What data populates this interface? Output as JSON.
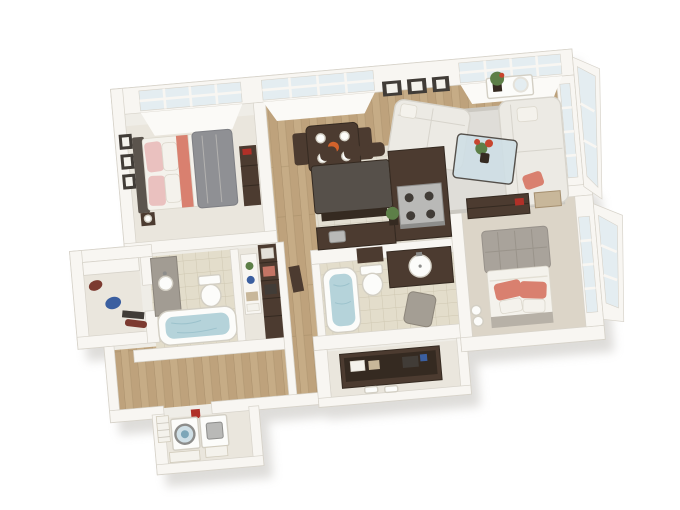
{
  "scene": {
    "type": "3d-isometric-floor-plan",
    "description": "Top-down 3D rendering of a two bedroom, two bathroom apartment floor plan on a white background, rotated slightly counterclockwise",
    "rooms": [
      {
        "name": "bedroom-1",
        "furniture": [
          "bed-gray-duvet",
          "pink-pillows",
          "coral-throw",
          "headboard",
          "dresser",
          "nightstand-lamp",
          "wall-frames-x3",
          "picture-window"
        ]
      },
      {
        "name": "dining-area",
        "furniture": [
          "dark-wood-table",
          "two-chairs",
          "place-settings",
          "orange-bowl",
          "window"
        ]
      },
      {
        "name": "living-room",
        "furniture": [
          "white-sofa",
          "white-chaise-sofa",
          "coral-accent-pillow",
          "glass-coffee-table",
          "flower-centerpiece",
          "area-rug",
          "console-table",
          "potted-plant",
          "round-mirror",
          "wall-frames-x3",
          "corner-window-wall"
        ]
      },
      {
        "name": "kitchen",
        "furniture": [
          "granite-island",
          "three-bar-stools",
          "l-shaped-espresso-counter",
          "stainless-range",
          "sink",
          "potted-plant"
        ]
      },
      {
        "name": "bedroom-2",
        "furniture": [
          "bed-white-duvet",
          "tufted-headboard",
          "coral-pillows",
          "media-console",
          "wood-chest",
          "window-wall"
        ]
      },
      {
        "name": "bathroom-1",
        "furniture": [
          "bathtub",
          "gray-vanity-sink",
          "toilet",
          "linen-shelf"
        ]
      },
      {
        "name": "bathroom-2",
        "furniture": [
          "bathtub",
          "toilet",
          "espresso-vanity-round-sink",
          "wall-cabinet",
          "hamper"
        ]
      },
      {
        "name": "walk-in-closet",
        "furniture": [
          "espresso-wardrobe",
          "storage-shelf",
          "hall-console"
        ]
      },
      {
        "name": "closet-2",
        "furniture": [
          "espresso-shelving-unit",
          "storage-boxes",
          "step-stools"
        ]
      },
      {
        "name": "storage-closet",
        "furniture": [
          "shelf",
          "maroon-bag",
          "blue-bag",
          "accessories"
        ]
      },
      {
        "name": "laundry-room",
        "furniture": [
          "front-load-washer",
          "dryer",
          "red-detergent",
          "laundry-baskets"
        ]
      }
    ],
    "palette": {
      "bg": "#ffffff",
      "wallBase": "#efede7",
      "wall": "#f8f6f2",
      "wallLight": "#fbfaf7",
      "wallEdge": "#d7d3ca",
      "shadow": "#a9a59e",
      "wood": "#c6ac86",
      "woodDark": "#b3976f",
      "woodLine": "#9e8460",
      "tile": "#e4dfd2",
      "tileLine": "#d1cbbb",
      "bathTile": "#e3ddcb",
      "bathTileLine": "#cfc8b2",
      "paleFloor": "#eae6dd",
      "warmFloor": "#dcd5c8",
      "glass": "#e4edf1",
      "glassDark": "#cfdfe6",
      "frameDark": "#413c37",
      "espresso": "#4c3b30",
      "espressoDark": "#352a21",
      "granite": "#56504a",
      "stainless": "#b9b9b7",
      "stainlessDark": "#8d8d8b",
      "sofa": "#eceae4",
      "sofaShade": "#d7d4cc",
      "rug": "#dfddd8",
      "rugEdge": "#cbc8c1",
      "bedGray": "#8f9094",
      "bedGrayLine": "#7e7f84",
      "headboard1": "#5b544d",
      "headboard2": "#a9a39b",
      "pinkPillow": "#eac1bf",
      "whiteFabric": "#f4f2ec",
      "coral": "#d9806f",
      "porcelain": "#fcfcfa",
      "porcelainEdge": "#d3cfc4",
      "water": "#b5d3da",
      "waterDeep": "#9cc2cc",
      "grayCab": "#a29c93",
      "plant": "#5d7f48",
      "flowerRed": "#c7452f",
      "orange": "#d2622b",
      "blue": "#3b5fa0",
      "redItem": "#b03028",
      "maroon": "#7c3a30",
      "hamper": "#a49e94",
      "tan": "#c8b79a",
      "blanketGray": "#b7b1a7"
    }
  }
}
